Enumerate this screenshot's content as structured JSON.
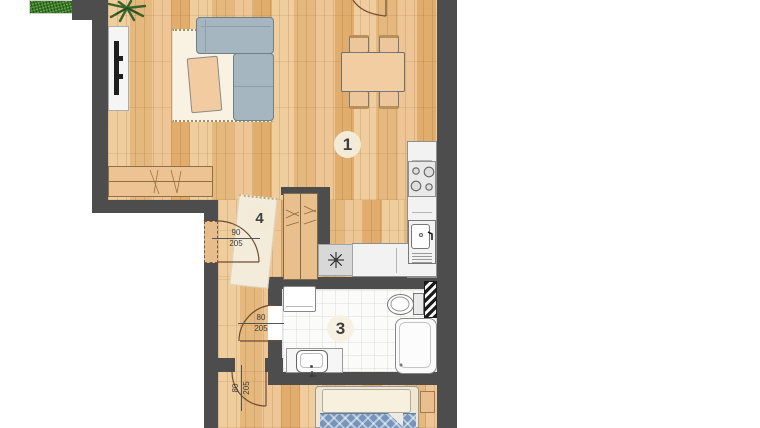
{
  "floorplan": {
    "room_labels": [
      {
        "number": "1"
      },
      {
        "number": "3"
      },
      {
        "number": "4"
      }
    ],
    "door_dimensions": [
      {
        "id": "entrance-door",
        "width": "90",
        "height": "205"
      },
      {
        "id": "bathroom-door",
        "width": "80",
        "height": "205"
      },
      {
        "id": "bedroom-door",
        "width": "80",
        "height": "205"
      }
    ],
    "icons": {
      "utility": "asterisk-six-spoke",
      "plant": "spiky-plant"
    }
  },
  "panel": {
    "area_table": {
      "rows": [
        {
          "label": "Powierzchnia użytkowa",
          "value": "57,50 m²"
        },
        {
          "label": "Ogród",
          "value": "20,24 m²"
        }
      ]
    },
    "contact": {
      "heading": "Zadzwoń i dowiedz się więcej:",
      "phone": "+48 690 42 41 42"
    }
  },
  "colors": {
    "wall": "#4d4d4d",
    "wood_light": "#f0cd9c",
    "wood_dark": "#e0ad6c",
    "grass": "#3f7b2a",
    "sofa": "#a6b6c0",
    "furniture_peach": "#f2cba0",
    "rug_cream": "#f9f2e2",
    "duvet_blue": "#7795bb"
  }
}
